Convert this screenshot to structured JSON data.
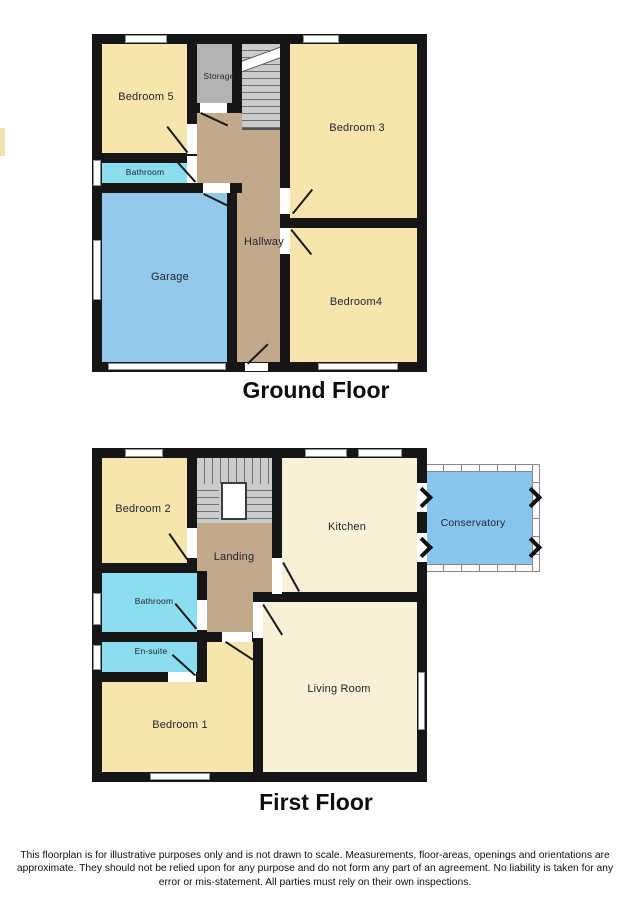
{
  "ground_floor": {
    "title": "Ground Floor",
    "rooms": {
      "bedroom5": "Bedroom 5",
      "storage": "Storage",
      "bedroom3": "Bedroom 3",
      "bathroom": "Bathroom",
      "garage": "Garage",
      "hallway": "Hallway",
      "bedroom4": "Bedroom4"
    }
  },
  "first_floor": {
    "title": "First Floor",
    "rooms": {
      "bedroom2": "Bedroom 2",
      "landing": "Landing",
      "kitchen": "Kitchen",
      "conservatory": "Conservatory",
      "bathroom": "Bathroom",
      "ensuite": "En-suite",
      "bedroom1": "Bedroom 1",
      "living_room": "Living Room"
    }
  },
  "disclaimer": "This floorplan is for illustrative purposes only and is not drawn to scale. Measurements, floor-areas, openings and orientations are approximate. They should not be relied upon for any purpose and do not form any part of an agreement. No liability is taken for any error or mis-statement. All parties must rely on their own inspections.",
  "colors": {
    "wall": "#161616",
    "bedroom_cream": "#f6e5ad",
    "kitchen_cream": "#f8f1d8",
    "bathroom_cyan": "#8adef0",
    "garage_blue": "#92c8ea",
    "conservatory_blue": "#87c5ec",
    "hall_tan": "#c3a98c",
    "storage_gray": "#b3b3b3",
    "stairs_gray": "#cbcbcb"
  }
}
